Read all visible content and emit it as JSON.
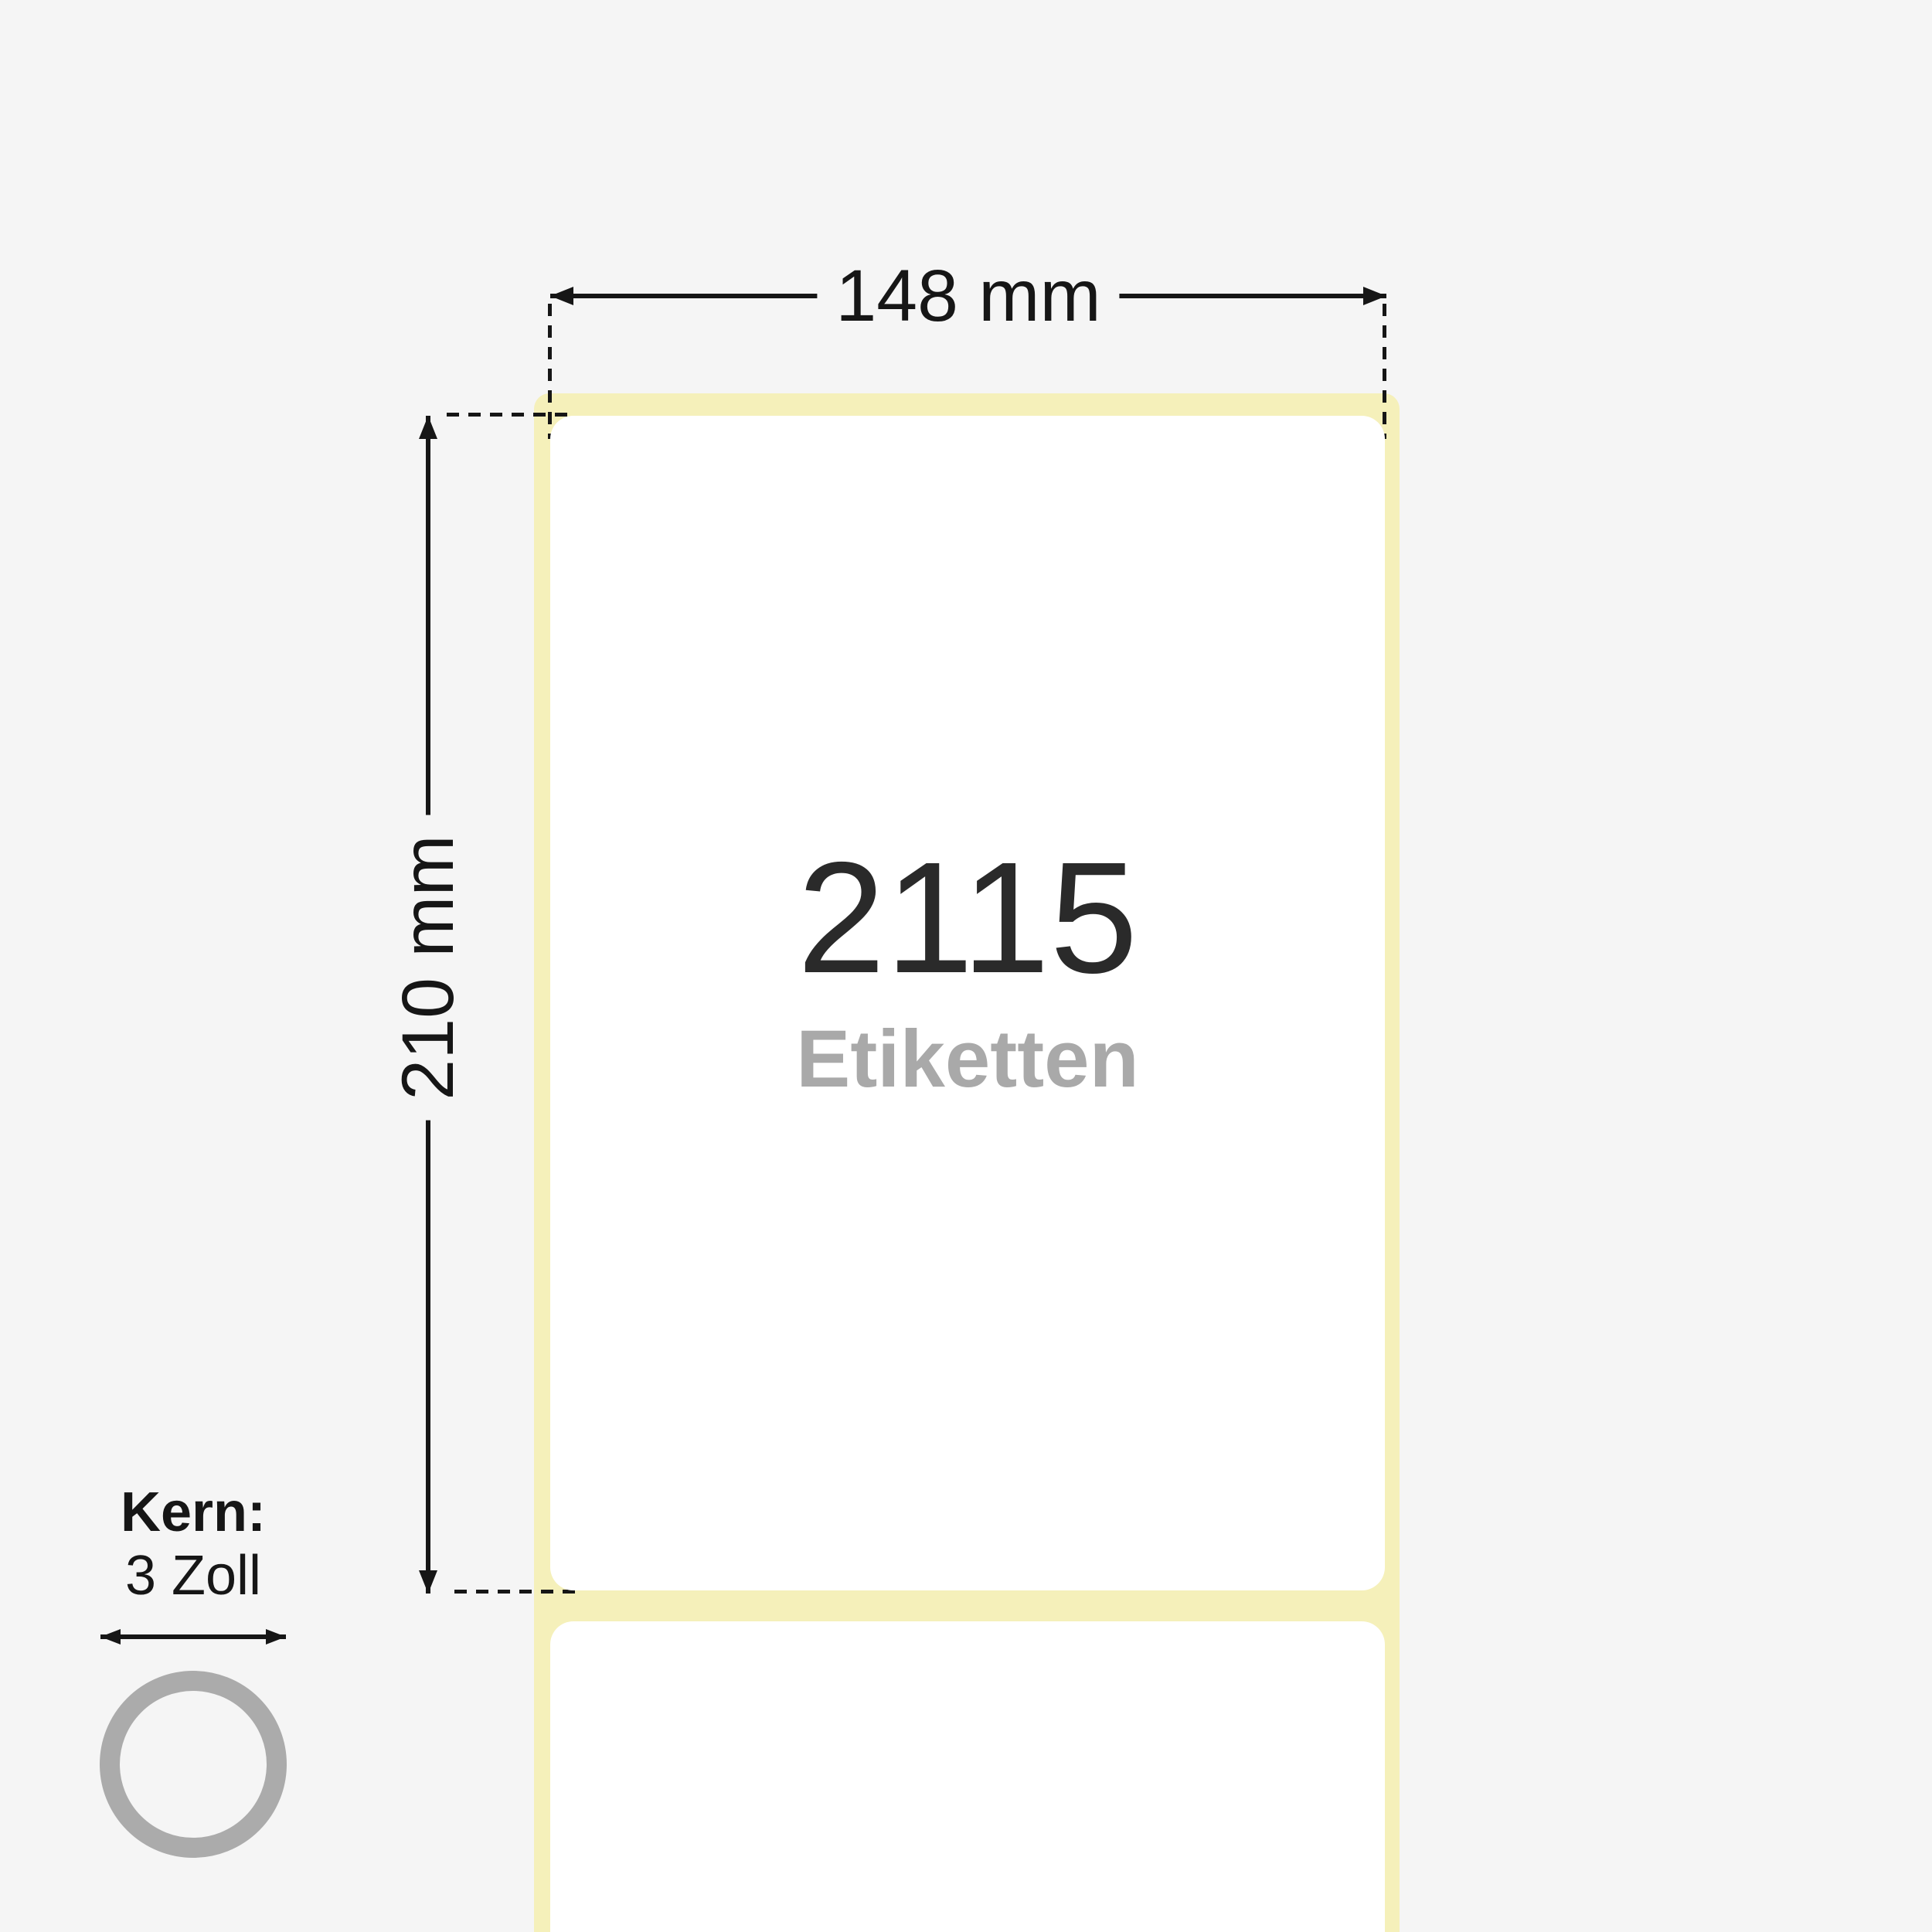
{
  "product": {
    "width_label": "148 mm",
    "height_label": "210 mm",
    "count": "2115",
    "count_unit": "Etiketten",
    "core_title": "Kern:",
    "core_value": "3 Zoll"
  },
  "colors": {
    "background": "#f5f5f5",
    "liner": "#f5f0ba",
    "label": "#ffffff",
    "dimension": "#161616",
    "count_text": "#2a2a2a",
    "unit_text": "#a9a9a9",
    "ring": "#ababab"
  }
}
